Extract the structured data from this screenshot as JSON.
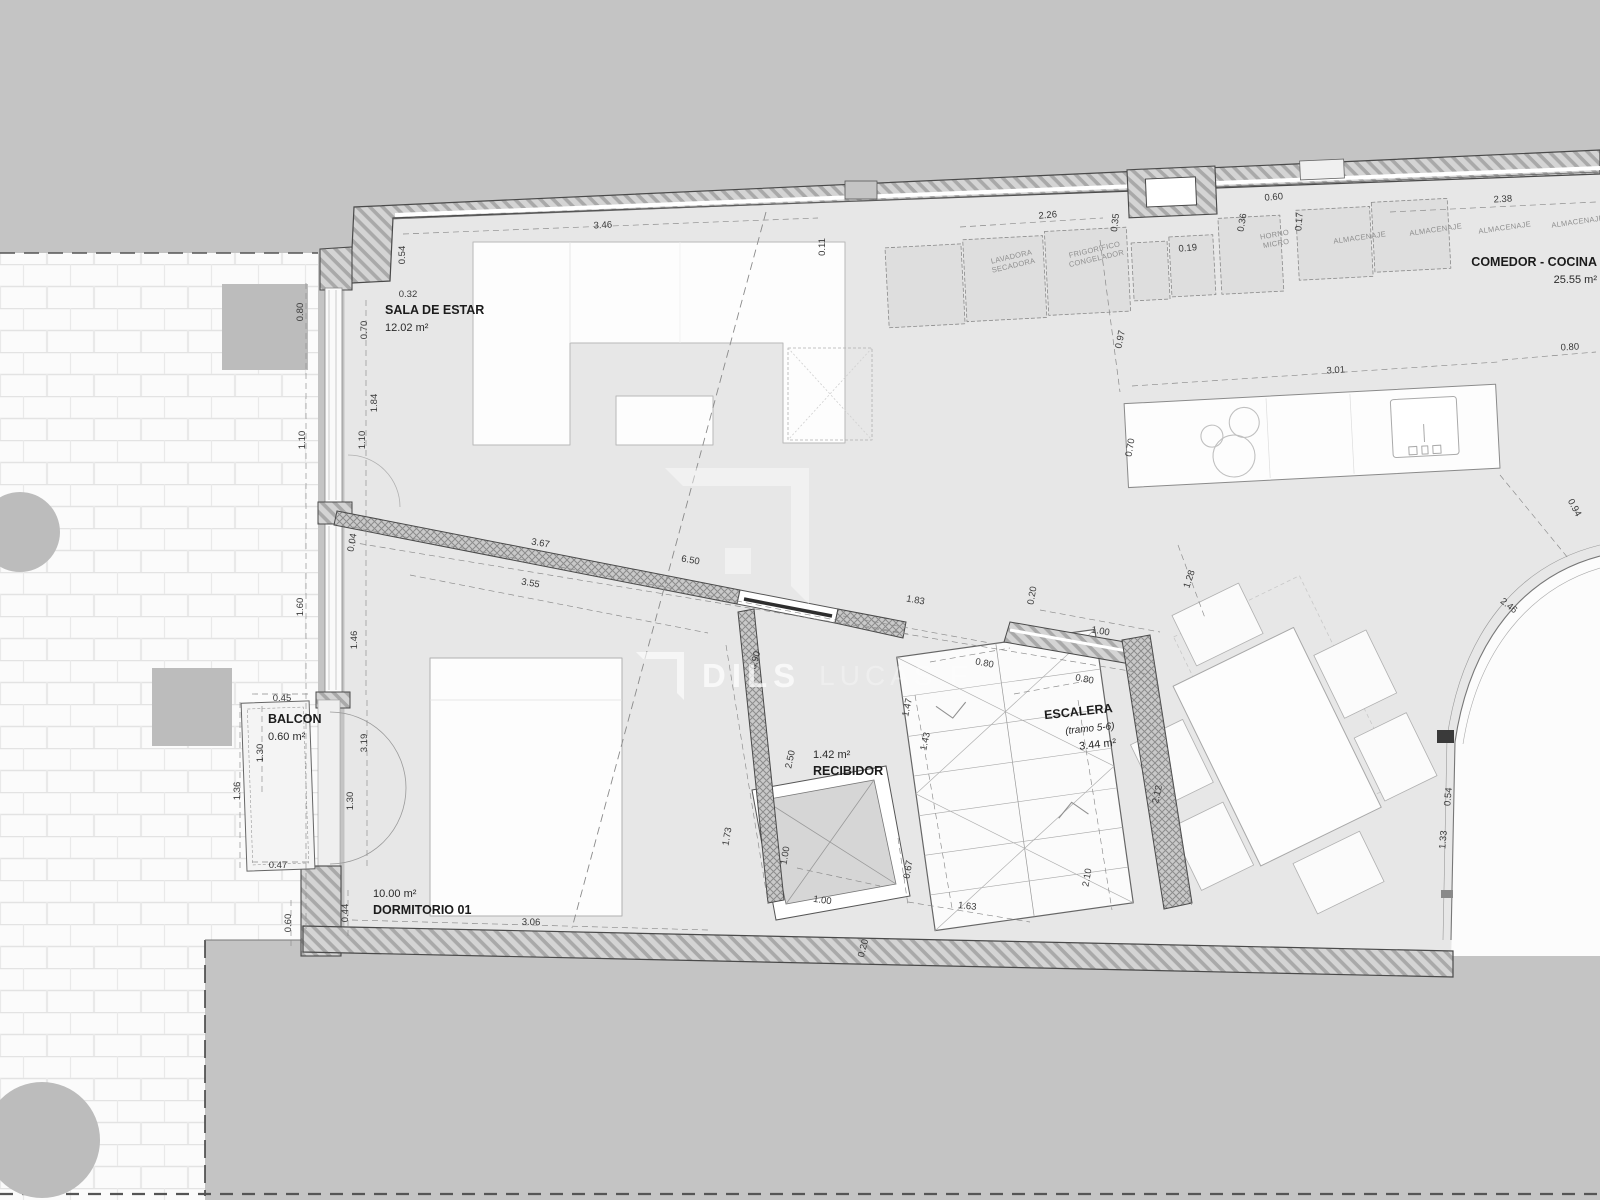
{
  "watermark": {
    "brand": "DILS",
    "partner": "LUCAS F"
  },
  "rooms": [
    {
      "name": "SALA DE ESTAR",
      "area": "12.02 m²",
      "x": 385,
      "y": 314,
      "anchor": "start",
      "r": 0,
      "area_first": false
    },
    {
      "name": "COMEDOR - COCINA",
      "area": "25.55 m²",
      "x": 1597,
      "y": 266,
      "anchor": "end",
      "r": 0,
      "area_first": false
    },
    {
      "name": "ESCALERA",
      "sub": "(tramo 5-6)",
      "area": "3.44 m²",
      "x": 1113,
      "y": 712,
      "anchor": "end",
      "r": -6,
      "area_first": false
    },
    {
      "name": "RECIBIDOR",
      "area": "1.42 m²",
      "x": 813,
      "y": 758,
      "anchor": "start",
      "r": 0,
      "area_first": true
    },
    {
      "name": "BALCON",
      "area": "0.60 m²",
      "x": 268,
      "y": 723,
      "anchor": "start",
      "r": 0,
      "area_first": false
    },
    {
      "name": "DORMITORIO 01",
      "area": "10.00 m²",
      "x": 373,
      "y": 897,
      "anchor": "start",
      "r": 0,
      "area_first": true
    }
  ],
  "appliances": [
    {
      "lines": [
        "LAVADORA",
        "SECADORA"
      ],
      "x": 1012,
      "y": 259,
      "r": -13
    },
    {
      "lines": [
        "FRIGORIFICO",
        "CONGELADOR"
      ],
      "x": 1095,
      "y": 252,
      "r": -13
    },
    {
      "lines": [
        "HORNO",
        "MICRO"
      ],
      "x": 1275,
      "y": 237,
      "r": -10
    },
    {
      "lines": [
        "ALMACENAJE"
      ],
      "x": 1360,
      "y": 240,
      "r": -8
    },
    {
      "lines": [
        "ALMACENAJE"
      ],
      "x": 1436,
      "y": 232,
      "r": -8
    },
    {
      "lines": [
        "ALMACENAJE"
      ],
      "x": 1505,
      "y": 230,
      "r": -8
    },
    {
      "lines": [
        "ALMACENAJE"
      ],
      "x": 1578,
      "y": 224,
      "r": -8
    }
  ],
  "dimensions": [
    {
      "v": "3.46",
      "x": 603,
      "y": 228,
      "r": -3
    },
    {
      "v": "0.54",
      "x": 405,
      "y": 255,
      "r": -90
    },
    {
      "v": "0.32",
      "x": 408,
      "y": 297,
      "r": 0
    },
    {
      "v": "0.80",
      "x": 303,
      "y": 312,
      "r": -90
    },
    {
      "v": "0.70",
      "x": 367,
      "y": 330,
      "r": -90
    },
    {
      "v": "1.84",
      "x": 377,
      "y": 403,
      "r": -90
    },
    {
      "v": "1.10",
      "x": 305,
      "y": 440,
      "r": -90
    },
    {
      "v": "1.10",
      "x": 365,
      "y": 440,
      "r": -90
    },
    {
      "v": "0.11",
      "x": 825,
      "y": 247,
      "r": -90
    },
    {
      "v": "2.26",
      "x": 1048,
      "y": 218,
      "r": -5
    },
    {
      "v": "0.35",
      "x": 1118,
      "y": 223,
      "r": -83
    },
    {
      "v": "0.19",
      "x": 1188,
      "y": 251,
      "r": -5
    },
    {
      "v": "0.36",
      "x": 1245,
      "y": 223,
      "r": -80
    },
    {
      "v": "0.60",
      "x": 1274,
      "y": 200,
      "r": -5
    },
    {
      "v": "0.17",
      "x": 1302,
      "y": 222,
      "r": -85
    },
    {
      "v": "2.38",
      "x": 1503,
      "y": 202,
      "r": -3
    },
    {
      "v": "0.97",
      "x": 1123,
      "y": 340,
      "r": -78
    },
    {
      "v": "3.01",
      "x": 1336,
      "y": 373,
      "r": -4
    },
    {
      "v": "0.70",
      "x": 1133,
      "y": 448,
      "r": -80
    },
    {
      "v": "0.80",
      "x": 1570,
      "y": 350,
      "r": -3
    },
    {
      "v": "0.94",
      "x": 1572,
      "y": 509,
      "r": 62
    },
    {
      "v": "2.46",
      "x": 1507,
      "y": 608,
      "r": 38
    },
    {
      "v": "1.28",
      "x": 1192,
      "y": 580,
      "r": -72
    },
    {
      "v": "1.60",
      "x": 303,
      "y": 607,
      "r": -90
    },
    {
      "v": "1.46",
      "x": 357,
      "y": 640,
      "r": -90
    },
    {
      "v": "0.04",
      "x": 355,
      "y": 543,
      "r": -80
    },
    {
      "v": "3.67",
      "x": 540,
      "y": 546,
      "r": 10
    },
    {
      "v": "6.50",
      "x": 690,
      "y": 563,
      "r": 10
    },
    {
      "v": "3.55",
      "x": 530,
      "y": 586,
      "r": 10
    },
    {
      "v": "1.83",
      "x": 915,
      "y": 603,
      "r": 10
    },
    {
      "v": "0.20",
      "x": 1035,
      "y": 596,
      "r": -80
    },
    {
      "v": "1.00",
      "x": 1100,
      "y": 634,
      "r": 10
    },
    {
      "v": "0.80",
      "x": 984,
      "y": 666,
      "r": 11
    },
    {
      "v": "0.80",
      "x": 1084,
      "y": 682,
      "r": 11
    },
    {
      "v": "1.47",
      "x": 910,
      "y": 708,
      "r": -78
    },
    {
      "v": "1.43",
      "x": 928,
      "y": 742,
      "r": -78
    },
    {
      "v": "0.90",
      "x": 758,
      "y": 661,
      "r": -75
    },
    {
      "v": "2.50",
      "x": 793,
      "y": 760,
      "r": -78
    },
    {
      "v": "1.73",
      "x": 730,
      "y": 837,
      "r": -80
    },
    {
      "v": "1.00",
      "x": 788,
      "y": 856,
      "r": -80
    },
    {
      "v": "1.00",
      "x": 822,
      "y": 903,
      "r": 8
    },
    {
      "v": "2.12",
      "x": 1160,
      "y": 795,
      "r": -78
    },
    {
      "v": "2.10",
      "x": 1090,
      "y": 878,
      "r": -80
    },
    {
      "v": "0.67",
      "x": 911,
      "y": 870,
      "r": -80
    },
    {
      "v": "1.63",
      "x": 967,
      "y": 909,
      "r": 6
    },
    {
      "v": "0.45",
      "x": 282,
      "y": 701,
      "r": 0
    },
    {
      "v": "1.30",
      "x": 263,
      "y": 753,
      "r": -90
    },
    {
      "v": "1.36",
      "x": 240,
      "y": 791,
      "r": -90
    },
    {
      "v": "3.19",
      "x": 367,
      "y": 743,
      "r": -90
    },
    {
      "v": "1.30",
      "x": 353,
      "y": 801,
      "r": -90
    },
    {
      "v": "0.47",
      "x": 278,
      "y": 868,
      "r": 0
    },
    {
      "v": "0.60",
      "x": 291,
      "y": 923,
      "r": -90
    },
    {
      "v": "0.44",
      "x": 348,
      "y": 913,
      "r": -90
    },
    {
      "v": "3.06",
      "x": 531,
      "y": 925,
      "r": 1
    },
    {
      "v": "0.54",
      "x": 1451,
      "y": 797,
      "r": -85
    },
    {
      "v": "1.33",
      "x": 1446,
      "y": 840,
      "r": -85
    },
    {
      "v": "0.20",
      "x": 866,
      "y": 949,
      "r": -75
    }
  ]
}
